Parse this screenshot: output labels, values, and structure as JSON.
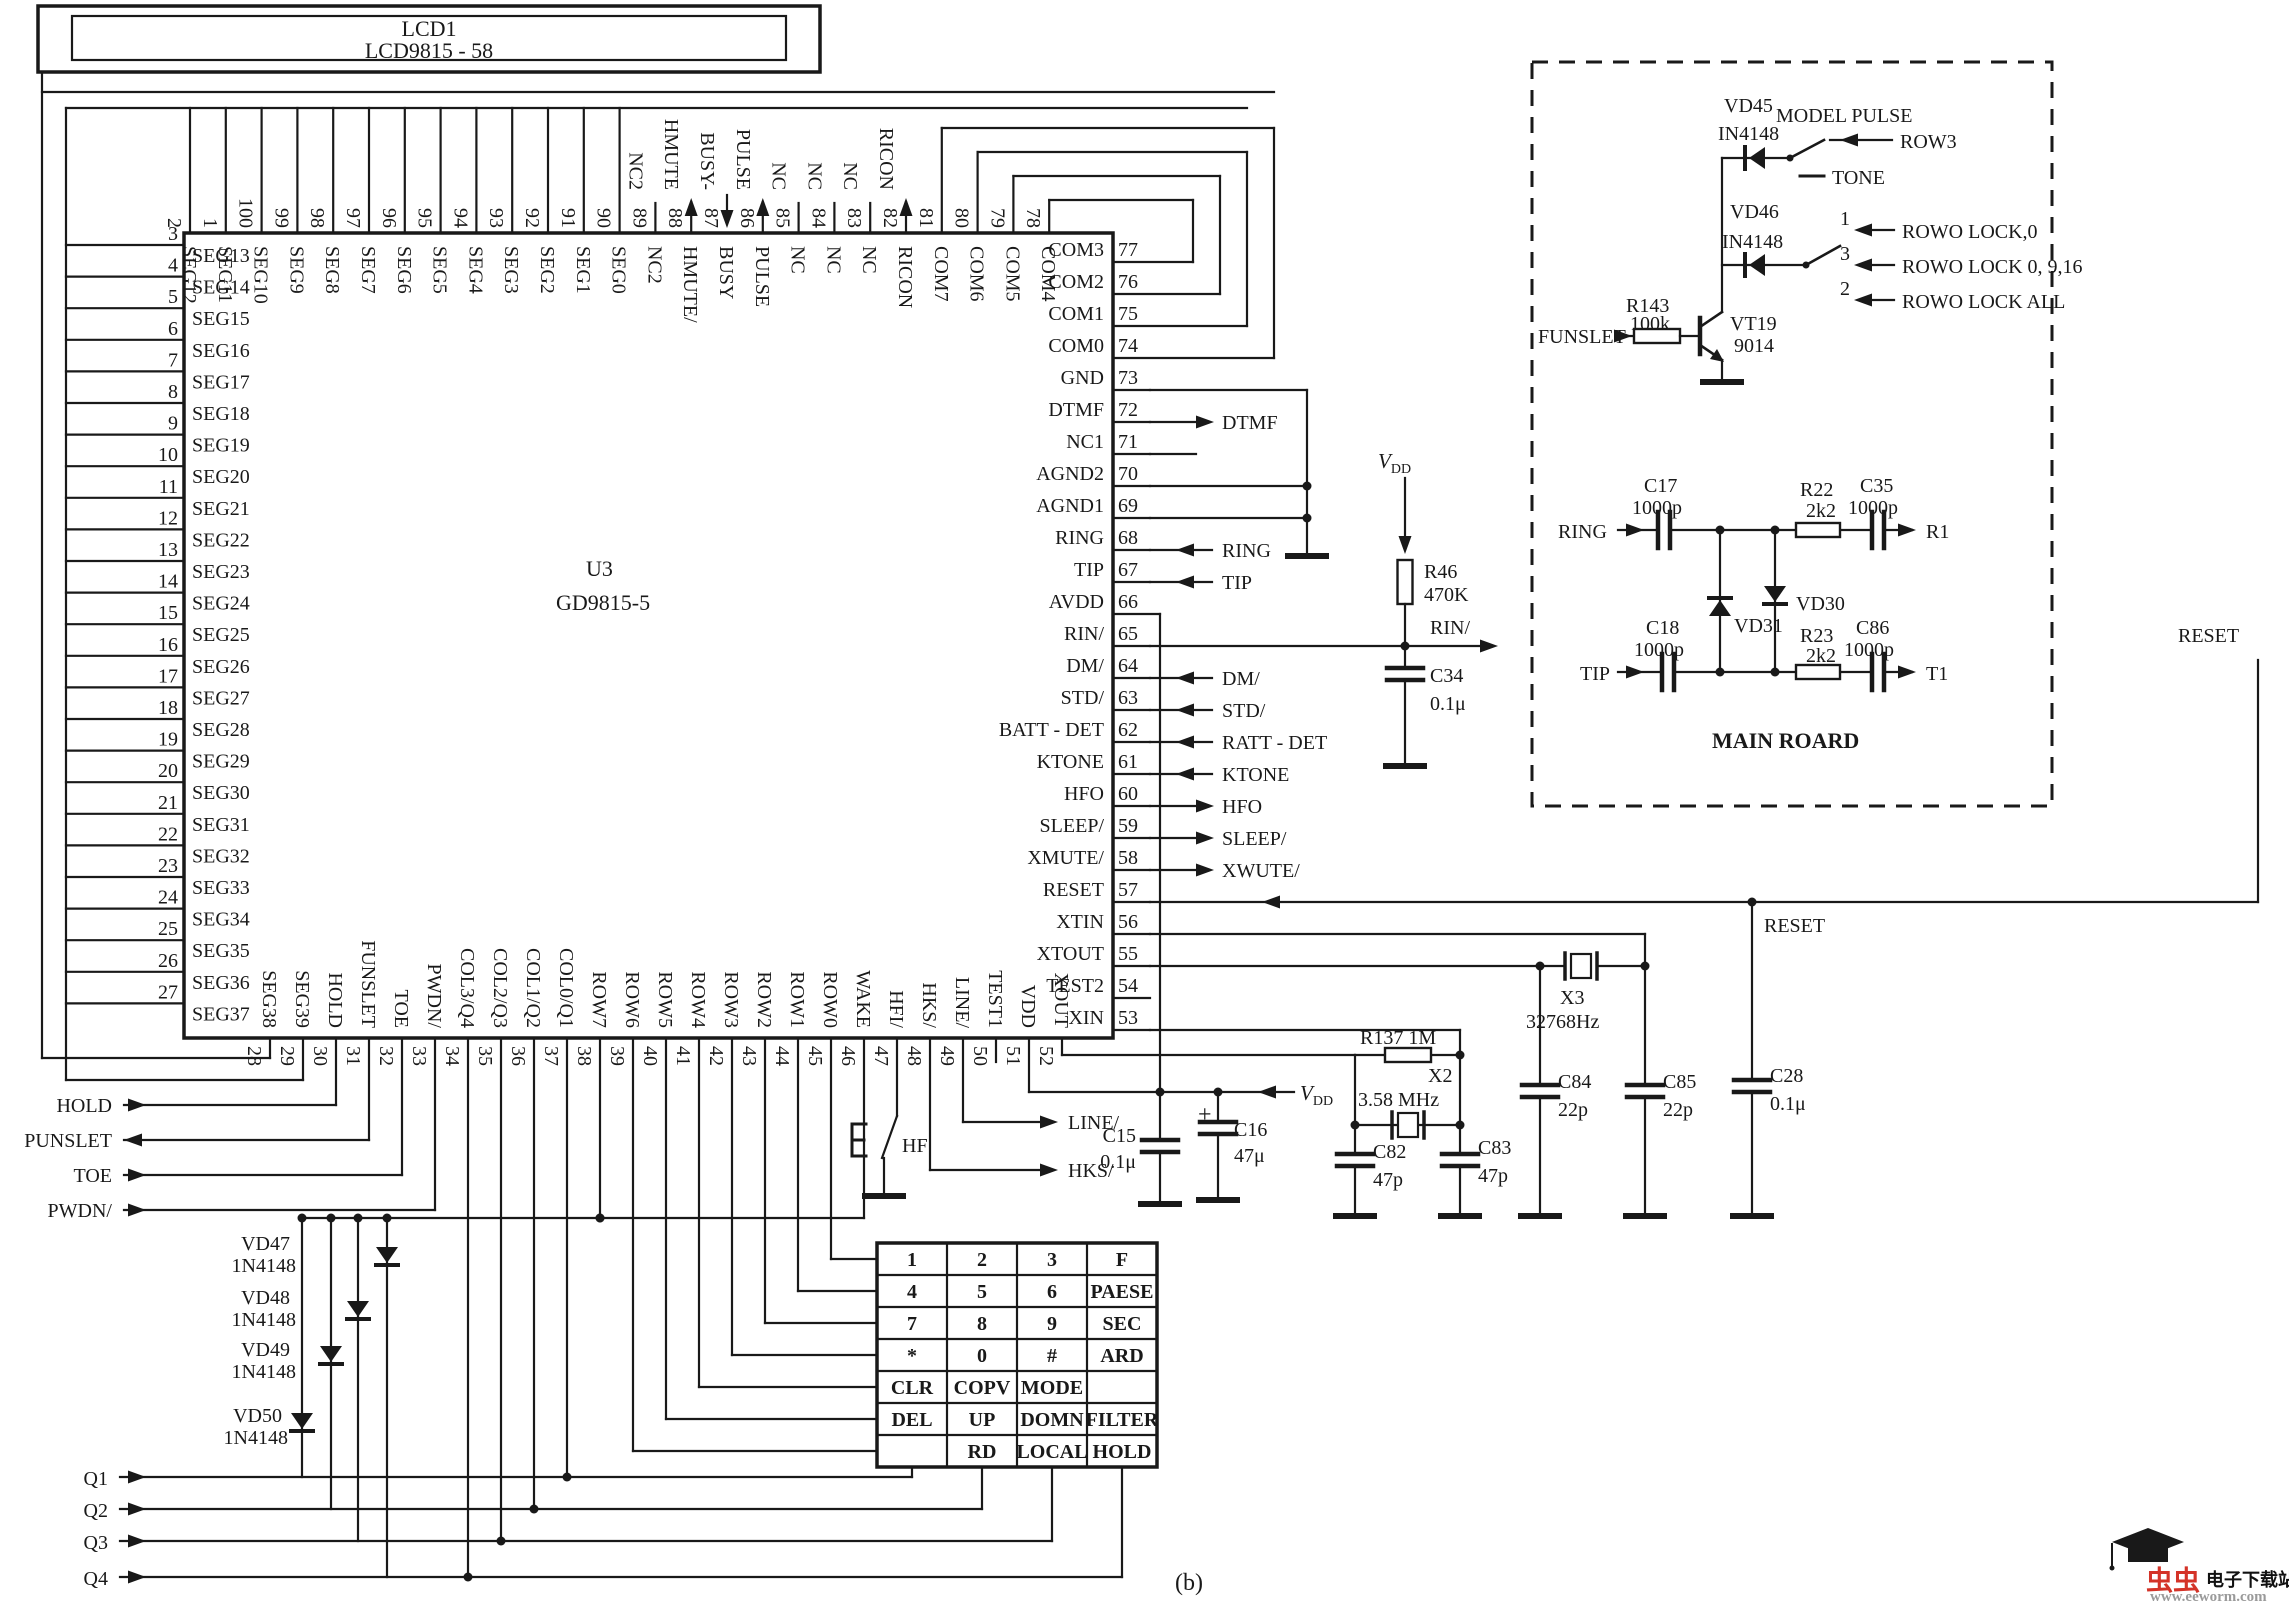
{
  "lcd": {
    "ref": "LCD1",
    "model": "LCD9815 - 58"
  },
  "chip": {
    "ref": "U3",
    "model": "GD9815-5",
    "left_pins": [
      {
        "num": "3",
        "label": "SEG13"
      },
      {
        "num": "4",
        "label": "SEG14"
      },
      {
        "num": "5",
        "label": "SEG15"
      },
      {
        "num": "6",
        "label": "SEG16"
      },
      {
        "num": "7",
        "label": "SEG17"
      },
      {
        "num": "8",
        "label": "SEG18"
      },
      {
        "num": "9",
        "label": "SEG19"
      },
      {
        "num": "10",
        "label": "SEG20"
      },
      {
        "num": "11",
        "label": "SEG21"
      },
      {
        "num": "12",
        "label": "SEG22"
      },
      {
        "num": "13",
        "label": "SEG23"
      },
      {
        "num": "14",
        "label": "SEG24"
      },
      {
        "num": "15",
        "label": "SEG25"
      },
      {
        "num": "16",
        "label": "SEG26"
      },
      {
        "num": "17",
        "label": "SEG27"
      },
      {
        "num": "18",
        "label": "SEG28"
      },
      {
        "num": "19",
        "label": "SEG29"
      },
      {
        "num": "20",
        "label": "SEG30"
      },
      {
        "num": "21",
        "label": "SEG31"
      },
      {
        "num": "22",
        "label": "SEG32"
      },
      {
        "num": "23",
        "label": "SEG33"
      },
      {
        "num": "24",
        "label": "SEG34"
      },
      {
        "num": "25",
        "label": "SEG35"
      },
      {
        "num": "26",
        "label": "SEG36"
      },
      {
        "num": "27",
        "label": "SEG37"
      }
    ],
    "top_pins": [
      {
        "num": "2",
        "label": "SEG12"
      },
      {
        "num": "1",
        "label": "SEG11"
      },
      {
        "num": "100",
        "label": "SEG10"
      },
      {
        "num": "99",
        "label": "SEG9"
      },
      {
        "num": "98",
        "label": "SEG8"
      },
      {
        "num": "97",
        "label": "SEG7"
      },
      {
        "num": "96",
        "label": "SEG6"
      },
      {
        "num": "95",
        "label": "SEG5"
      },
      {
        "num": "94",
        "label": "SEG4"
      },
      {
        "num": "93",
        "label": "SEG3"
      },
      {
        "num": "92",
        "label": "SEG2"
      },
      {
        "num": "91",
        "label": "SEG1"
      },
      {
        "num": "90",
        "label": "SEG0"
      },
      {
        "num": "89",
        "label": "NC2",
        "ext": "NC2"
      },
      {
        "num": "88",
        "label": "HMUTE/",
        "ext": "HMUTE",
        "arrow": "up"
      },
      {
        "num": "87",
        "label": "BUSY",
        "ext": "BUSY-",
        "arrow": "down"
      },
      {
        "num": "86",
        "label": "PULSE",
        "ext": "PULSE",
        "arrow": "up"
      },
      {
        "num": "85",
        "label": "NC",
        "ext": "NC"
      },
      {
        "num": "84",
        "label": "NC",
        "ext": "NC"
      },
      {
        "num": "83",
        "label": "NC",
        "ext": "NC"
      },
      {
        "num": "82",
        "label": "RICON",
        "ext": "RICON",
        "arrow": "up"
      },
      {
        "num": "81",
        "label": "COM7"
      },
      {
        "num": "80",
        "label": "COM6"
      },
      {
        "num": "79",
        "label": "COM5"
      },
      {
        "num": "78",
        "label": "COM4"
      }
    ],
    "right_pins": [
      {
        "num": "77",
        "label": "COM3"
      },
      {
        "num": "76",
        "label": "COM2"
      },
      {
        "num": "75",
        "label": "COM1"
      },
      {
        "num": "74",
        "label": "COM0"
      },
      {
        "num": "73",
        "label": "GND"
      },
      {
        "num": "72",
        "label": "DTMF",
        "ext": "DTMF",
        "dir": "r"
      },
      {
        "num": "71",
        "label": "NC1"
      },
      {
        "num": "70",
        "label": "AGND2"
      },
      {
        "num": "69",
        "label": "AGND1"
      },
      {
        "num": "68",
        "label": "RING",
        "ext": "RING",
        "dir": "l"
      },
      {
        "num": "67",
        "label": "TIP",
        "ext": "TIP",
        "dir": "l"
      },
      {
        "num": "66",
        "label": "AVDD"
      },
      {
        "num": "65",
        "label": "RIN/"
      },
      {
        "num": "64",
        "label": "DM/",
        "ext": "DM/",
        "dir": "l"
      },
      {
        "num": "63",
        "label": "STD/",
        "ext": "STD/",
        "dir": "l"
      },
      {
        "num": "62",
        "label": "BATT - DET",
        "ext": "RATT - DET",
        "dir": "l"
      },
      {
        "num": "61",
        "label": "KTONE",
        "ext": "KTONE",
        "dir": "l"
      },
      {
        "num": "60",
        "label": "HFO",
        "ext": "HFO",
        "dir": "r"
      },
      {
        "num": "59",
        "label": "SLEEP/",
        "ext": "SLEEP/",
        "dir": "r"
      },
      {
        "num": "58",
        "label": "XMUTE/",
        "ext": "XWUTE/",
        "dir": "r"
      },
      {
        "num": "57",
        "label": "RESET"
      },
      {
        "num": "56",
        "label": "XTIN"
      },
      {
        "num": "55",
        "label": "XTOUT"
      },
      {
        "num": "54",
        "label": "TEST2"
      },
      {
        "num": "53",
        "label": "XIN"
      }
    ],
    "bottom_pins": [
      {
        "num": "28",
        "label": "SEG38"
      },
      {
        "num": "29",
        "label": "SEG39"
      },
      {
        "num": "30",
        "label": "HOLD"
      },
      {
        "num": "31",
        "label": "FUNSLET"
      },
      {
        "num": "32",
        "label": "TOE"
      },
      {
        "num": "33",
        "label": "PWDN/"
      },
      {
        "num": "34",
        "label": "COL3/Q4"
      },
      {
        "num": "35",
        "label": "COL2/Q3"
      },
      {
        "num": "36",
        "label": "COL1/Q2"
      },
      {
        "num": "37",
        "label": "COL0/Q1"
      },
      {
        "num": "38",
        "label": "ROW7"
      },
      {
        "num": "39",
        "label": "ROW6"
      },
      {
        "num": "40",
        "label": "ROW5"
      },
      {
        "num": "41",
        "label": "ROW4"
      },
      {
        "num": "42",
        "label": "ROW3"
      },
      {
        "num": "43",
        "label": "ROW2"
      },
      {
        "num": "44",
        "label": "ROW1"
      },
      {
        "num": "45",
        "label": "ROW0"
      },
      {
        "num": "46",
        "label": "WAKE"
      },
      {
        "num": "47",
        "label": "HFI/"
      },
      {
        "num": "48",
        "label": "HKS/"
      },
      {
        "num": "49",
        "label": "LINE/"
      },
      {
        "num": "50",
        "label": "TEST1"
      },
      {
        "num": "51",
        "label": "VDD"
      },
      {
        "num": "52",
        "label": "XOUT"
      }
    ]
  },
  "left_signals": [
    {
      "label": "HOLD",
      "dir": "right"
    },
    {
      "label": "PUNSLET",
      "dir": "left"
    },
    {
      "label": "TOE",
      "dir": "right"
    },
    {
      "label": "PWDN/",
      "dir": "right"
    }
  ],
  "q_outputs": [
    "Q1",
    "Q2",
    "Q3",
    "Q4"
  ],
  "key_diodes": [
    {
      "ref": "VD47",
      "value": "1N4148"
    },
    {
      "ref": "VD48",
      "value": "1N4148"
    },
    {
      "ref": "VD49",
      "value": "1N4148"
    },
    {
      "ref": "VD50",
      "value": "1N4148"
    }
  ],
  "hf_switch_label": "HF",
  "power": {
    "vdd": "VDD",
    "c15": {
      "ref": "C15",
      "value": "0.1μ"
    },
    "c16": {
      "ref": "C16",
      "value": "47μ"
    }
  },
  "osc": {
    "r137": "R137 1M",
    "x2": {
      "ref": "X2",
      "value": "3.58 MHz"
    },
    "c82": {
      "ref": "C82",
      "value": "47p"
    },
    "c83": {
      "ref": "C83",
      "value": "47p"
    },
    "x3": {
      "ref": "X3",
      "value": "32768Hz"
    },
    "c84": {
      "ref": "C84",
      "value": "22p"
    },
    "c85": {
      "ref": "C85",
      "value": "22p"
    },
    "c28": {
      "ref": "C28",
      "value": "0.1μ"
    }
  },
  "ring_detect": {
    "vdd": "VDD",
    "r46": {
      "ref": "R46",
      "value": "470K"
    },
    "c34": {
      "ref": "C34",
      "value": "0.1μ"
    },
    "rin": "RIN/"
  },
  "nets": {
    "reset_mid": "RESET",
    "reset_right": "RESET",
    "line": "LINE/",
    "hks": "HKS/"
  },
  "dashed_box": {
    "top": {
      "vd45": {
        "ref": "VD45",
        "value": "IN4148"
      },
      "vd46": {
        "ref": "VD46",
        "value": "IN4148"
      },
      "model_pulse": "MODEL  PULSE",
      "tone": "TONE",
      "row3": "ROW3",
      "positions": [
        "1",
        "3",
        "2"
      ],
      "locks": [
        "ROWO LOCK,0",
        "ROWO LOCK 0,  9,16",
        "ROWO LOCK ALL"
      ],
      "funslet": "FUNSLET",
      "r143": {
        "ref": "R143",
        "value": "100k"
      },
      "vt19": {
        "ref": "VT19",
        "value": "9014"
      }
    },
    "main_board": {
      "title": "MAIN ROARD",
      "ring": "RING",
      "tip": "TIP",
      "r1": "R1",
      "t1": "T1",
      "c17": {
        "ref": "C17",
        "value": "1000p"
      },
      "c18": {
        "ref": "C18",
        "value": "1000p"
      },
      "c35": {
        "ref": "C35",
        "value": "1000p"
      },
      "c86": {
        "ref": "C86",
        "value": "1000p"
      },
      "r22": {
        "ref": "R22",
        "value": "2k2"
      },
      "r23": {
        "ref": "R23",
        "value": "2k2"
      },
      "vd30": "VD30",
      "vd31": "VD31"
    }
  },
  "keypad": {
    "rows": [
      [
        "1",
        "2",
        "3",
        "F"
      ],
      [
        "4",
        "5",
        "6",
        "PAESE"
      ],
      [
        "7",
        "8",
        "9",
        "SEC"
      ],
      [
        "*",
        "0",
        "#",
        "ARD"
      ],
      [
        "CLR",
        "COPV",
        "MODE",
        ""
      ],
      [
        "DEL",
        "UP",
        "DOMN",
        "FILTER"
      ],
      [
        "",
        "RD",
        "LOCAL",
        "HOLD"
      ]
    ]
  },
  "figure_label": "(b)",
  "watermark": {
    "brand": "虫虫",
    "site": "电子下载站",
    "url": "www.eeworm.com"
  }
}
